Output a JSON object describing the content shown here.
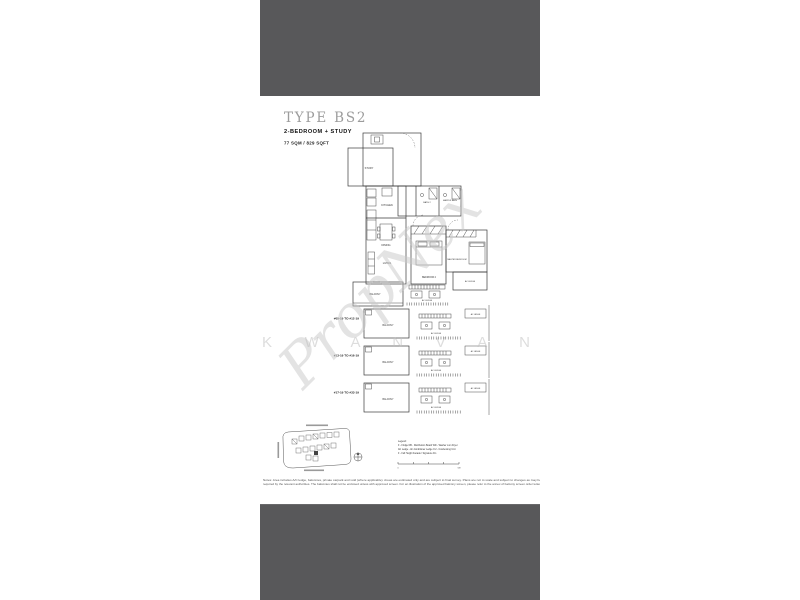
{
  "header": {
    "title": "TYPE BS2",
    "subtitle": "2-BEDROOM + STUDY",
    "area": "77 SQM / 829 SQFT"
  },
  "floorplan": {
    "rooms": {
      "study": "STUDY",
      "kitchen": "KITCHEN",
      "dining": "DINING",
      "living": "LIVING",
      "bath2": "BATH 2",
      "master_bath": "MASTER BATH",
      "bedroom2": "BEDROOM 2",
      "master_bedroom": "MASTER BEDROOM",
      "balcony": "BALCONY",
      "ac_ledge": "AC LEDGE"
    },
    "floors": [
      "#05-19 TO #12-19",
      "#13-19 TO #16-19",
      "#17-19 TO #33-19"
    ]
  },
  "watermark": {
    "brand": "PropNex",
    "letters": "K W A N V A N"
  },
  "legend": {
    "heading": "Legend:",
    "line1": "F - Fridge      DB - Distribution Board      WD - Washer cum Dryer",
    "line2": "AC Ledge - Air-Conditioner Ledge      CU - Condensing Unit",
    "line3": "F - Full Height Facade / Signature Fin"
  },
  "scalebar": {
    "zero": "0",
    "max": "5M"
  },
  "disclaimer": {
    "line1": "Notes: Area includes A/C ledge, balconies, private carpark and void (where applicable). Areas are estimated only and are subject to final survey. Plans are not to scale and subject to changes as may be",
    "line2": "required by the relevant authorities. The balconies shall not be enclosed unless with approved screen. For an illustration of the approved balcony screen, please refer to the annex of balcony screen order letter."
  },
  "colors": {
    "letterbox_bar": "#58585a",
    "plan_line": "#3a3a3a",
    "watermark_gray": "#c9c9c9"
  }
}
